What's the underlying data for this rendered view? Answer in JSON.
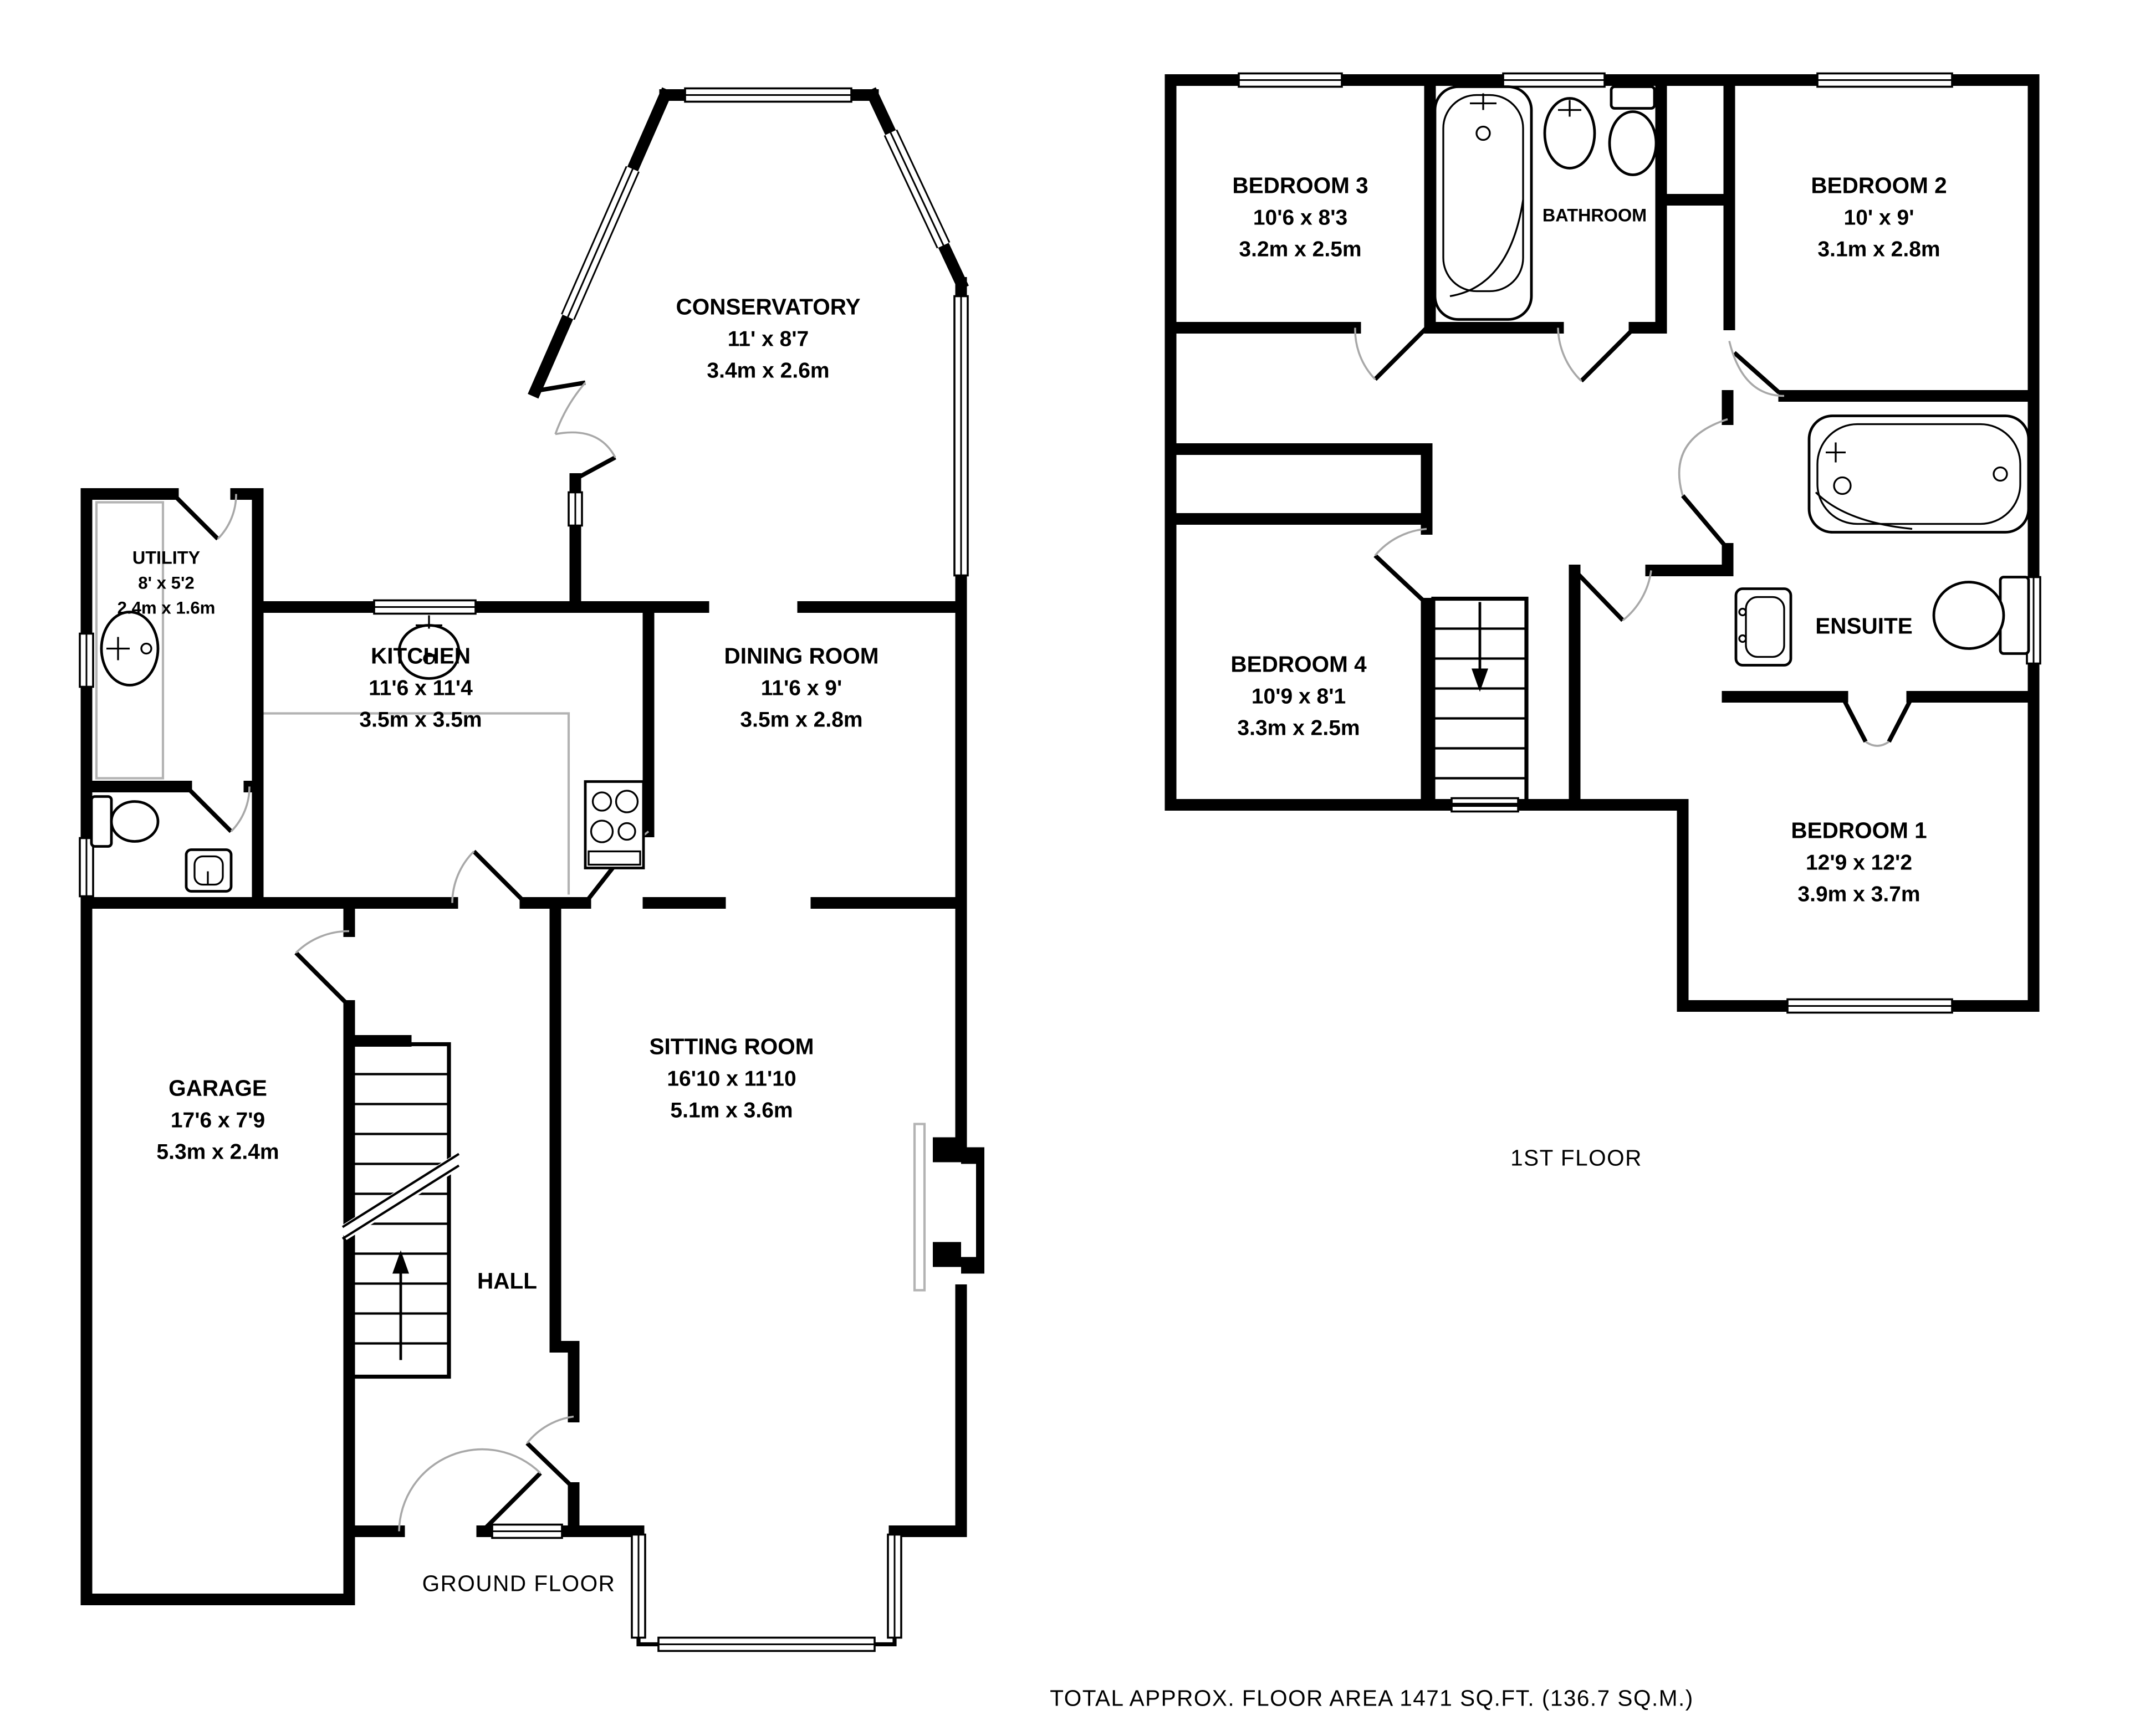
{
  "captions": {
    "ground_floor": "GROUND FLOOR",
    "first_floor": "1ST FLOOR",
    "total_area": "TOTAL APPROX. FLOOR AREA 1471 SQ.FT. (136.7 SQ.M.)"
  },
  "ground_floor": {
    "rooms": [
      {
        "id": "utility",
        "name": "UTILITY",
        "imperial": "8' x 5'2",
        "metric": "2.4m x 1.6m"
      },
      {
        "id": "kitchen",
        "name": "KITCHEN",
        "imperial": "11'6 x 11'4",
        "metric": "3.5m x 3.5m"
      },
      {
        "id": "dining-room",
        "name": "DINING ROOM",
        "imperial": "11'6 x 9'",
        "metric": "3.5m x 2.8m"
      },
      {
        "id": "conservatory",
        "name": "CONSERVATORY",
        "imperial": "11' x 8'7",
        "metric": "3.4m x 2.6m"
      },
      {
        "id": "garage",
        "name": "GARAGE",
        "imperial": "17'6 x 7'9",
        "metric": "5.3m x 2.4m"
      },
      {
        "id": "sitting-room",
        "name": "SITTING ROOM",
        "imperial": "16'10 x 11'10",
        "metric": "5.1m x 3.6m"
      },
      {
        "id": "hall",
        "name": "HALL"
      }
    ]
  },
  "first_floor": {
    "rooms": [
      {
        "id": "bedroom-3",
        "name": "BEDROOM 3",
        "imperial": "10'6 x 8'3",
        "metric": "3.2m x 2.5m"
      },
      {
        "id": "bathroom",
        "name": "BATHROOM"
      },
      {
        "id": "bedroom-2",
        "name": "BEDROOM 2",
        "imperial": "10' x 9'",
        "metric": "3.1m x 2.8m"
      },
      {
        "id": "bedroom-4",
        "name": "BEDROOM 4",
        "imperial": "10'9 x 8'1",
        "metric": "3.3m x 2.5m"
      },
      {
        "id": "ensuite",
        "name": "ENSUITE"
      },
      {
        "id": "bedroom-1",
        "name": "BEDROOM 1",
        "imperial": "12'9 x 12'2",
        "metric": "3.9m x 3.7m"
      }
    ]
  },
  "colors": {
    "wall": "#000000",
    "door_arc": "#a8a8a8",
    "counter": "#b3b3b3",
    "background": "#ffffff"
  }
}
